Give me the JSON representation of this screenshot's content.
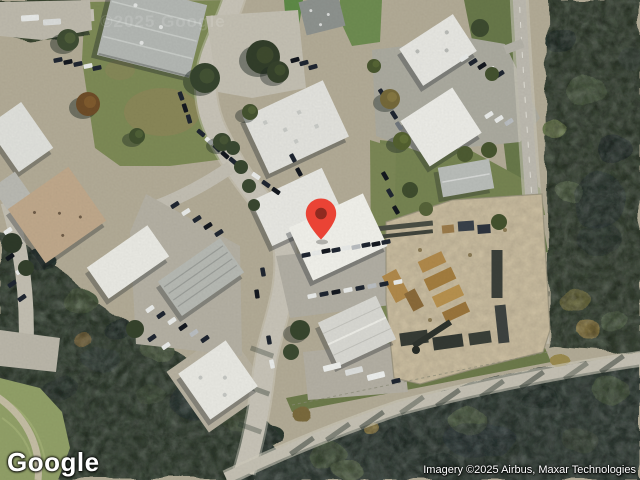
{
  "branding": {
    "logo_text": "Google"
  },
  "attribution": {
    "text": "Imagery ©2025 Airbus, Maxar Technologies"
  },
  "map": {
    "view_type": "satellite-imagery",
    "watermark": "©2025 Google",
    "pin": {
      "color": "#EA4335",
      "inner_color": "#8F2A20",
      "outline": "#B3271E"
    }
  }
}
